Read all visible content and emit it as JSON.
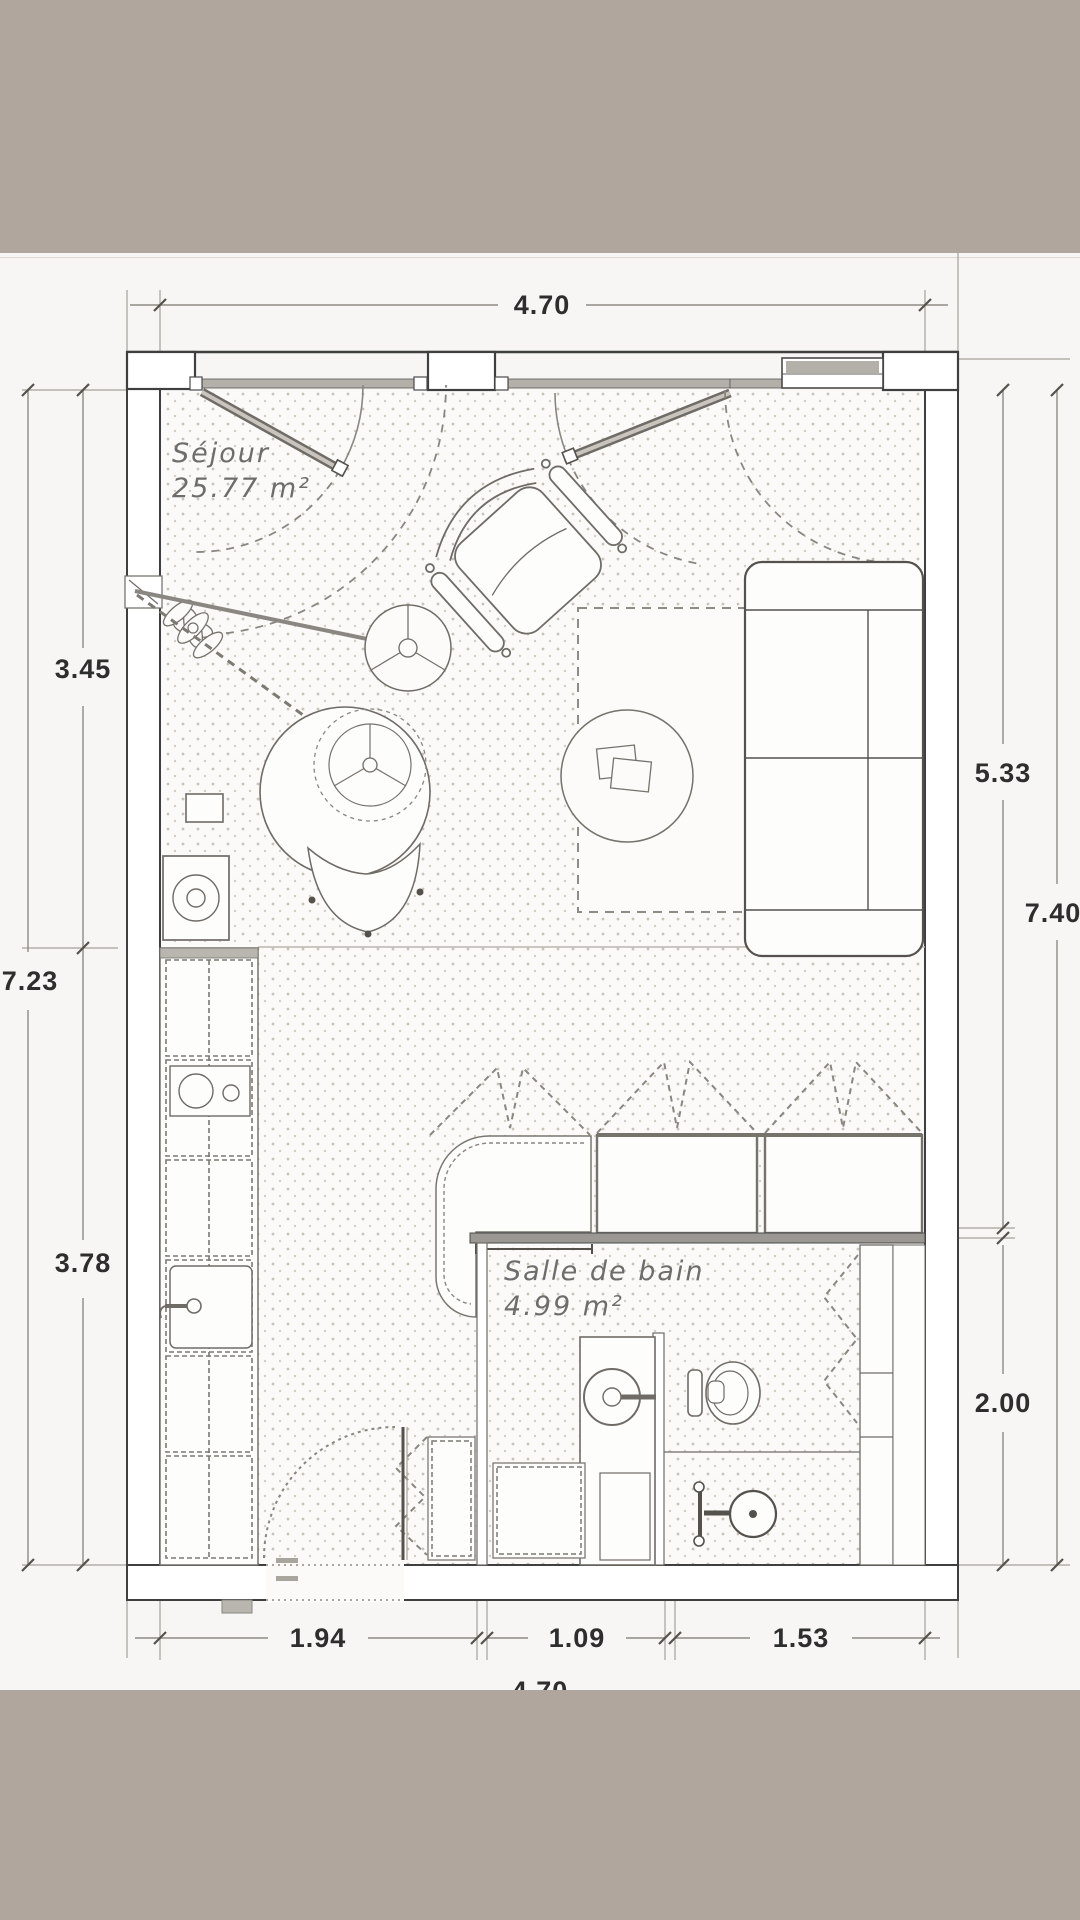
{
  "rooms": {
    "sejour": {
      "name": "Séjour",
      "area": "25.77 m²"
    },
    "salle_de_bain": {
      "name": "Salle de bain",
      "area": "4.99 m²"
    }
  },
  "dimensions": {
    "top_width": "4.70",
    "left_upper": "3.45",
    "left_total": "7.23",
    "left_lower": "3.78",
    "right_upper": "5.33",
    "right_total": "7.40",
    "right_lower": "2.00",
    "bottom_left": "1.94",
    "bottom_center": "1.09",
    "bottom_right": "1.53",
    "bottom_total": "4.70"
  },
  "colors": {
    "photo_bar": "#b0a69e",
    "wall_line": "#3f3f3f",
    "glazing_fill": "#b3afa9",
    "floor_dot": "#c9c3ba"
  }
}
